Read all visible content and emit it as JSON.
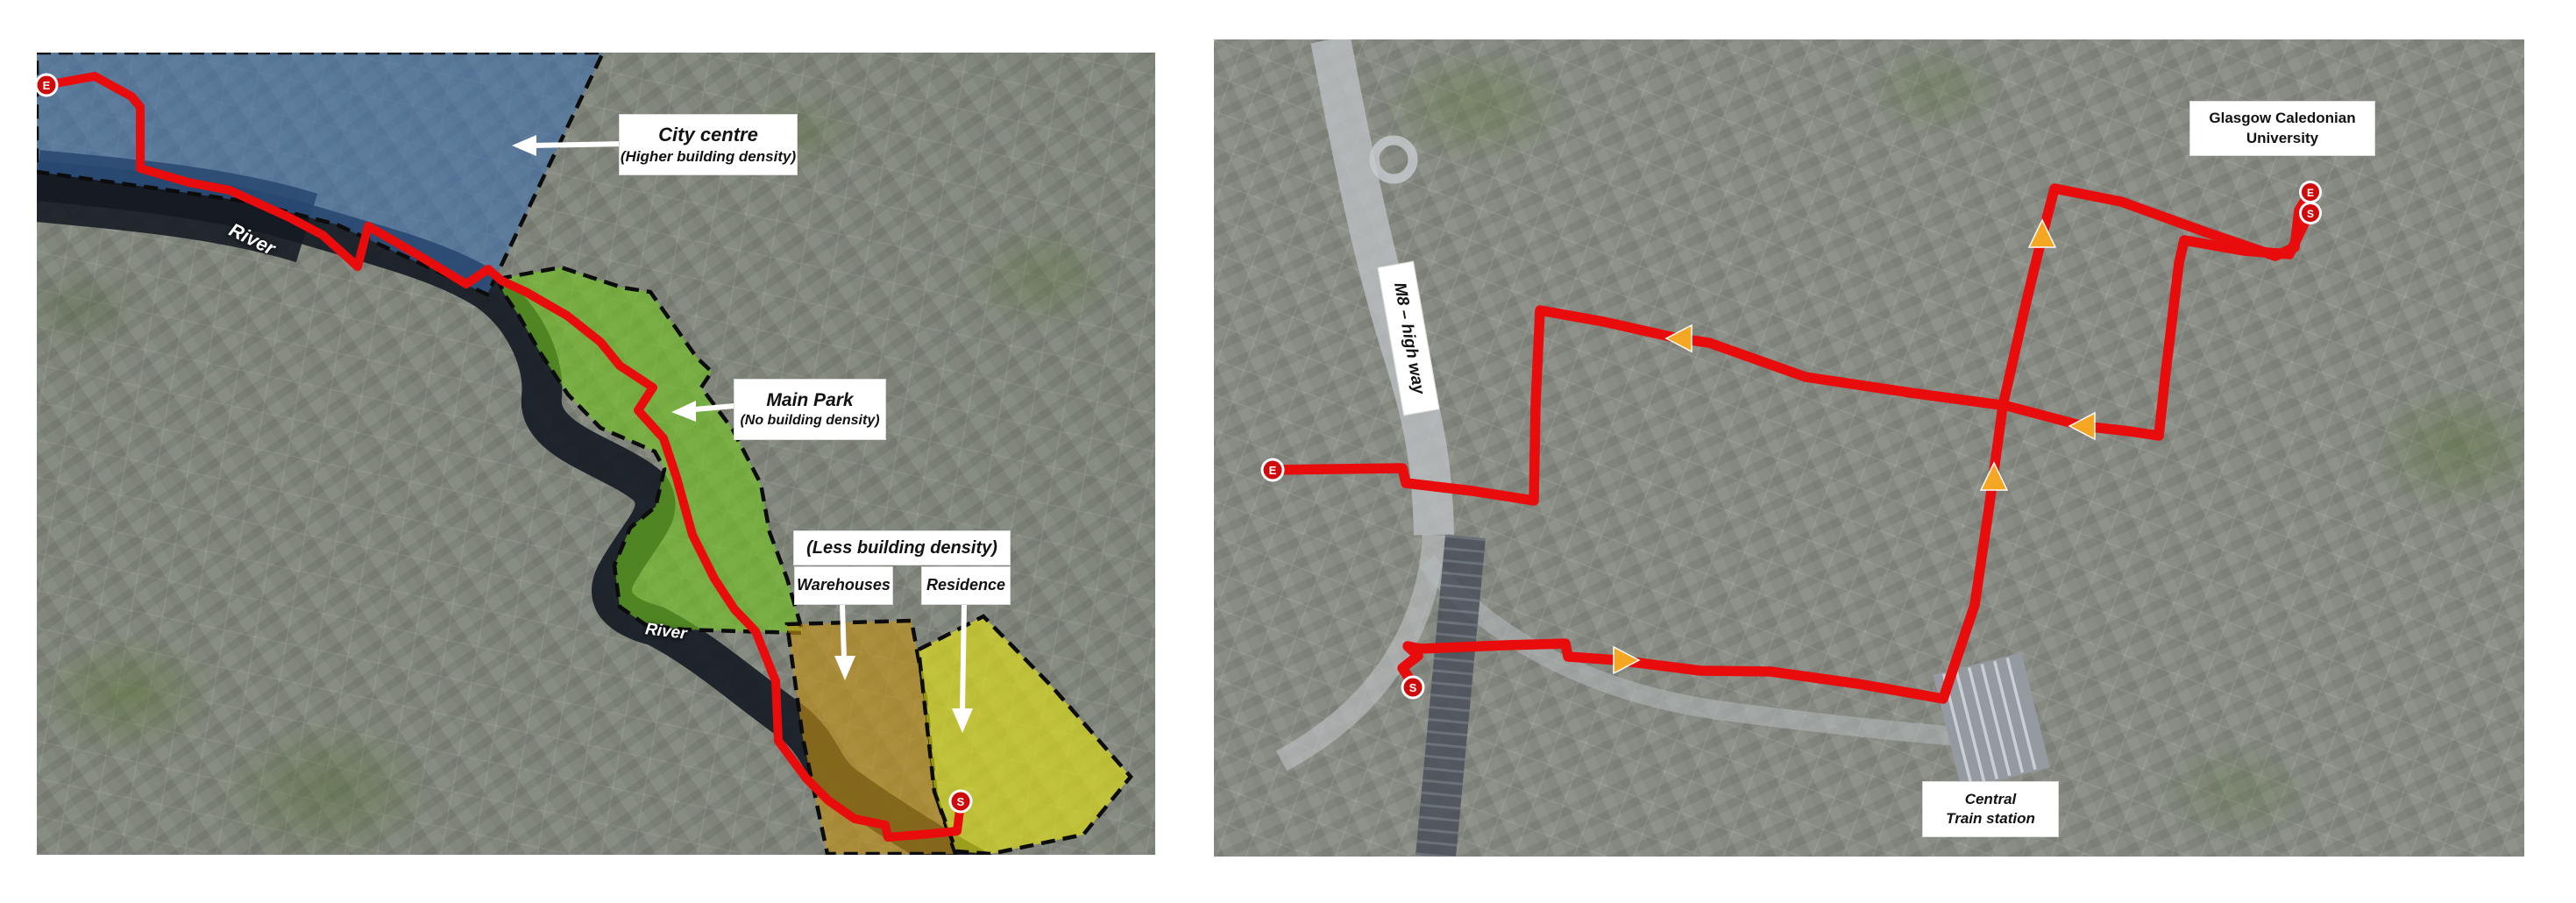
{
  "figure": {
    "description_left": "annotated satellite map with density regions and walking route",
    "description_right": "annotated satellite map with two walking routes to Glasgow Caledonian University"
  },
  "colors": {
    "route_red": "#e80c0c",
    "marker_red": "#cf0a0a",
    "marker_ring": "#ffffff",
    "arrow_orange": "#f5a623",
    "region_blue": "#3a70b2",
    "region_green": "#72c71e",
    "region_orange": "#c49114",
    "region_yellow": "#e0e014",
    "river_dark": "#141a22",
    "label_arrow_white": "#ffffff"
  },
  "left_map": {
    "labels": {
      "city_centre": {
        "line1": "City centre",
        "line2": "(Higher building density)"
      },
      "main_park": {
        "line1": "Main Park",
        "line2": "(No building density)"
      },
      "less_density": {
        "line1": "(Less building density)"
      },
      "warehouses": {
        "label": "Warehouses"
      },
      "residence": {
        "label": "Residence"
      },
      "river_upper": "River",
      "river_lower": "River"
    },
    "markers": [
      {
        "label": "E"
      },
      {
        "label": "S"
      }
    ],
    "regions": [
      {
        "name": "city-centre",
        "color": "#3a70b2"
      },
      {
        "name": "main-park",
        "color": "#72c71e"
      },
      {
        "name": "warehouses",
        "color": "#c49114"
      },
      {
        "name": "residence",
        "color": "#e0e014"
      }
    ]
  },
  "right_map": {
    "labels": {
      "university": {
        "line1": "Glasgow  Caledonian",
        "line2": "University"
      },
      "m8": "M8 – high way",
      "central_station": {
        "line1": "Central",
        "line2": "Train station"
      }
    },
    "markers": [
      {
        "label": "E"
      },
      {
        "label": "S"
      },
      {
        "label": "E"
      },
      {
        "label": "S"
      }
    ],
    "arrows": [
      {
        "direction": "left"
      },
      {
        "direction": "up"
      },
      {
        "direction": "left"
      },
      {
        "direction": "up"
      },
      {
        "direction": "right"
      }
    ]
  }
}
